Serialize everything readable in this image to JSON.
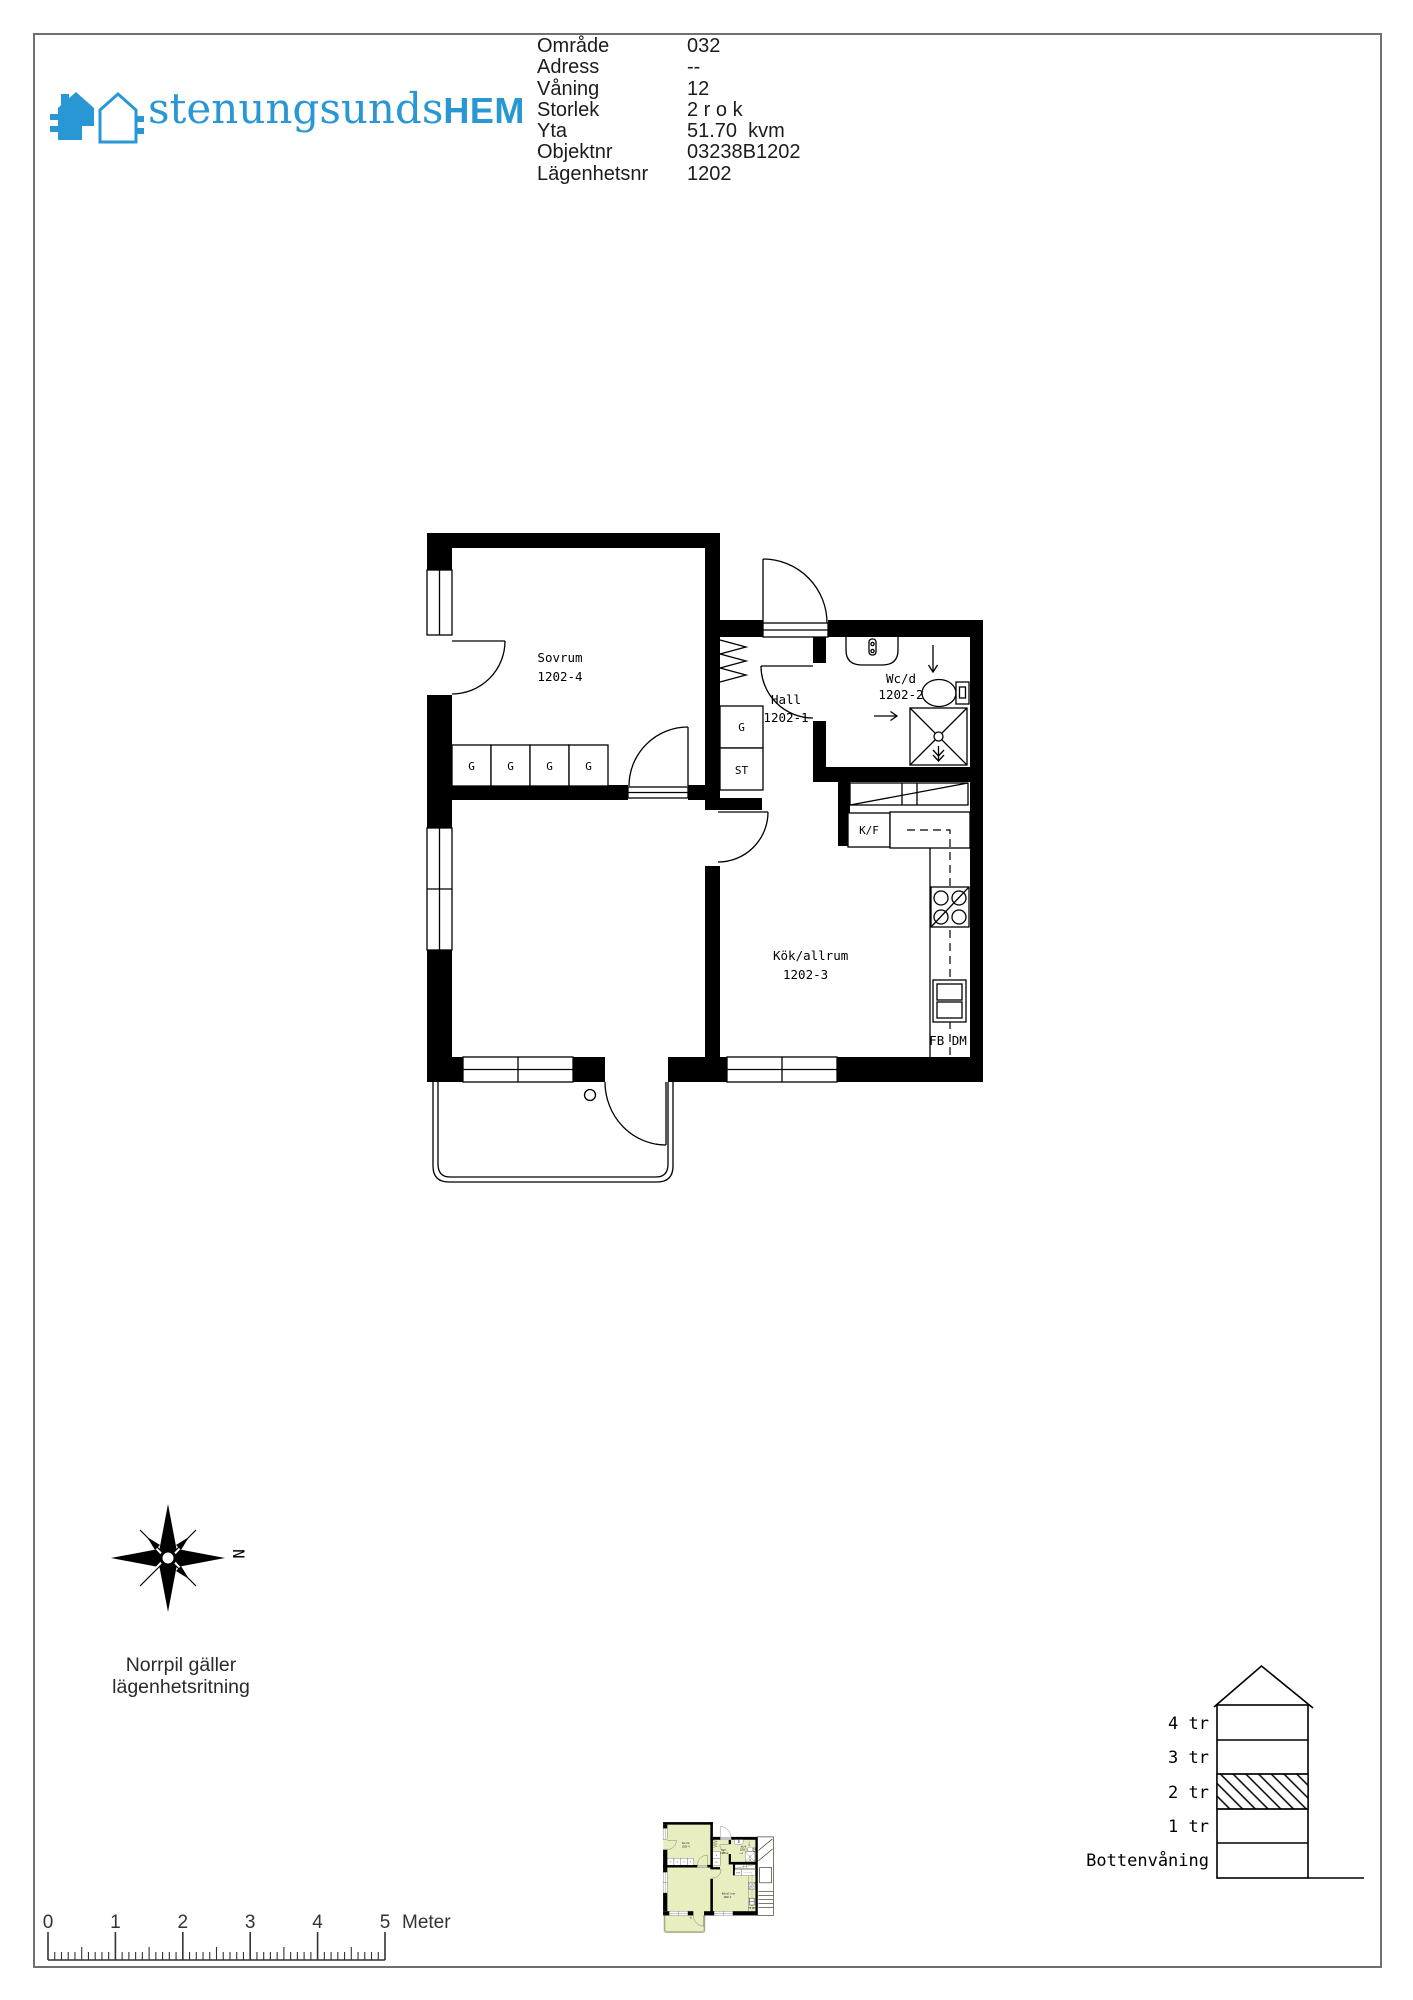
{
  "header": {
    "logo": {
      "brand_light": "stenungsunds",
      "brand_bold": "HEM"
    },
    "info_rows": [
      {
        "label": "Område",
        "value": "032"
      },
      {
        "label": "Adress",
        "value": "--"
      },
      {
        "label": "Våning",
        "value": "12"
      },
      {
        "label": "Storlek",
        "value": "2 r o k"
      },
      {
        "label": "Yta",
        "value": "51.70  kvm"
      },
      {
        "label": "Objektnr",
        "value": "03238B1202"
      },
      {
        "label": "Lägenhetsnr",
        "value": "1202"
      }
    ]
  },
  "floorplan": {
    "rooms": {
      "bedroom": {
        "name": "Sovrum",
        "number": "1202-4"
      },
      "hall": {
        "name": "Hall",
        "number": "1202-1"
      },
      "bathroom": {
        "name": "Wc/d",
        "number": "1202-2"
      },
      "kitchen": {
        "name": "Kök/allrum",
        "number": "1202-3"
      }
    },
    "wardrobes": [
      "G",
      "G",
      "G",
      "G"
    ],
    "fixtures": {
      "hall_wardrobe": "G",
      "cleaning_closet": "ST",
      "fridge_freezer": "K/F",
      "appliance_row": "FB DM"
    }
  },
  "compass": {
    "north": "N",
    "caption": [
      "Norrpil gäller",
      "lägenhetsritning"
    ]
  },
  "elevation": {
    "floors": [
      {
        "label": "4 tr"
      },
      {
        "label": "3 tr"
      },
      {
        "label": "2 tr",
        "highlighted": true
      },
      {
        "label": "1 tr"
      },
      {
        "label": "Bottenvåning"
      }
    ]
  },
  "scalebar": {
    "labels": [
      "0",
      "1",
      "2",
      "3",
      "4",
      "5"
    ],
    "unit": "Meter",
    "meters": 5,
    "minor_per_meter": 10
  },
  "colors": {
    "brand": "#2997d4",
    "mini_fill": "#e9eec0",
    "mini_ink": "#3c3c28"
  }
}
